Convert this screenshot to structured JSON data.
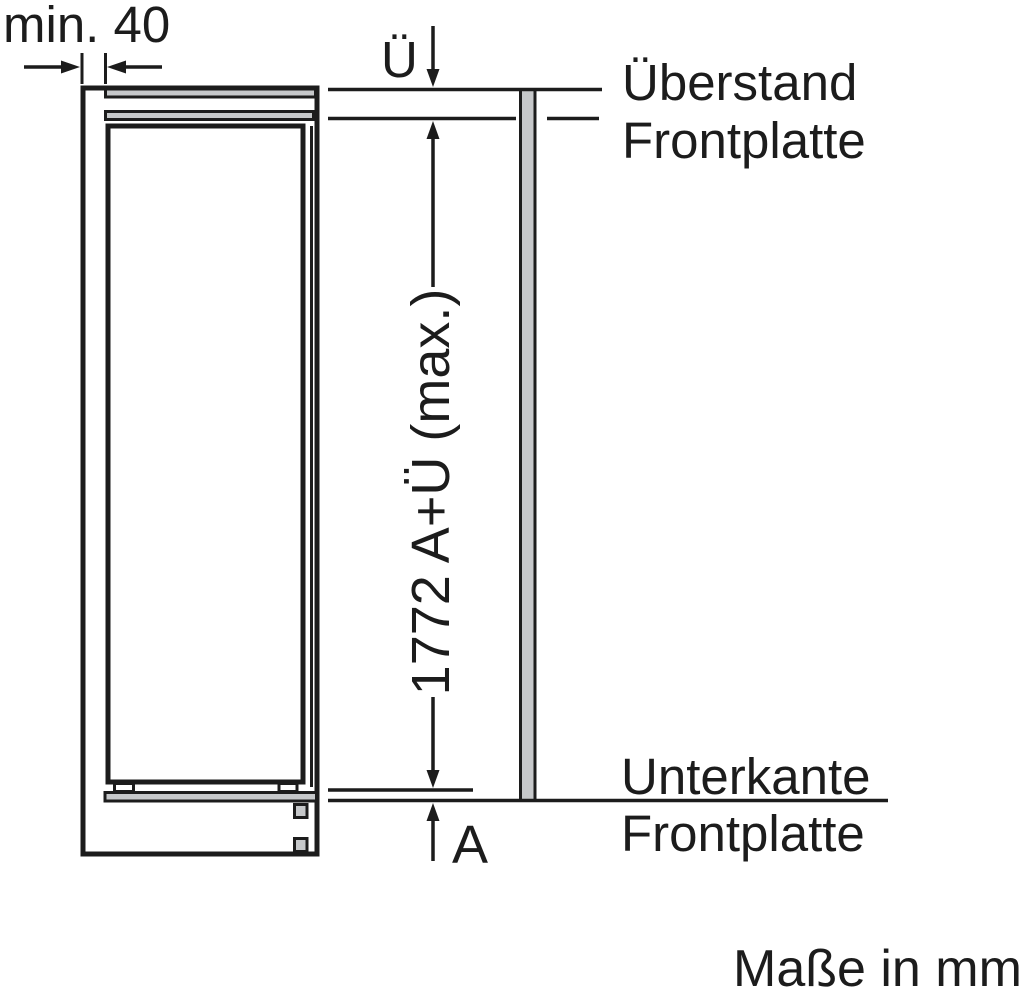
{
  "diagram": {
    "labels": {
      "min_clearance": "min. 40",
      "overhang_dim": "Ü",
      "overhang_label_line1": "Überstand",
      "overhang_label_line2": "Frontplatte",
      "height_dim": "1772 A+Ü (max.)",
      "bottom_dim": "A",
      "bottom_edge_label_line1": "Unterkante",
      "bottom_edge_label_line2": "Frontplatte",
      "units_note": "Maße in mm"
    },
    "colors": {
      "line": "#1c1c1c",
      "panel_fill": "#c6c8ca",
      "background": "#ffffff"
    }
  }
}
